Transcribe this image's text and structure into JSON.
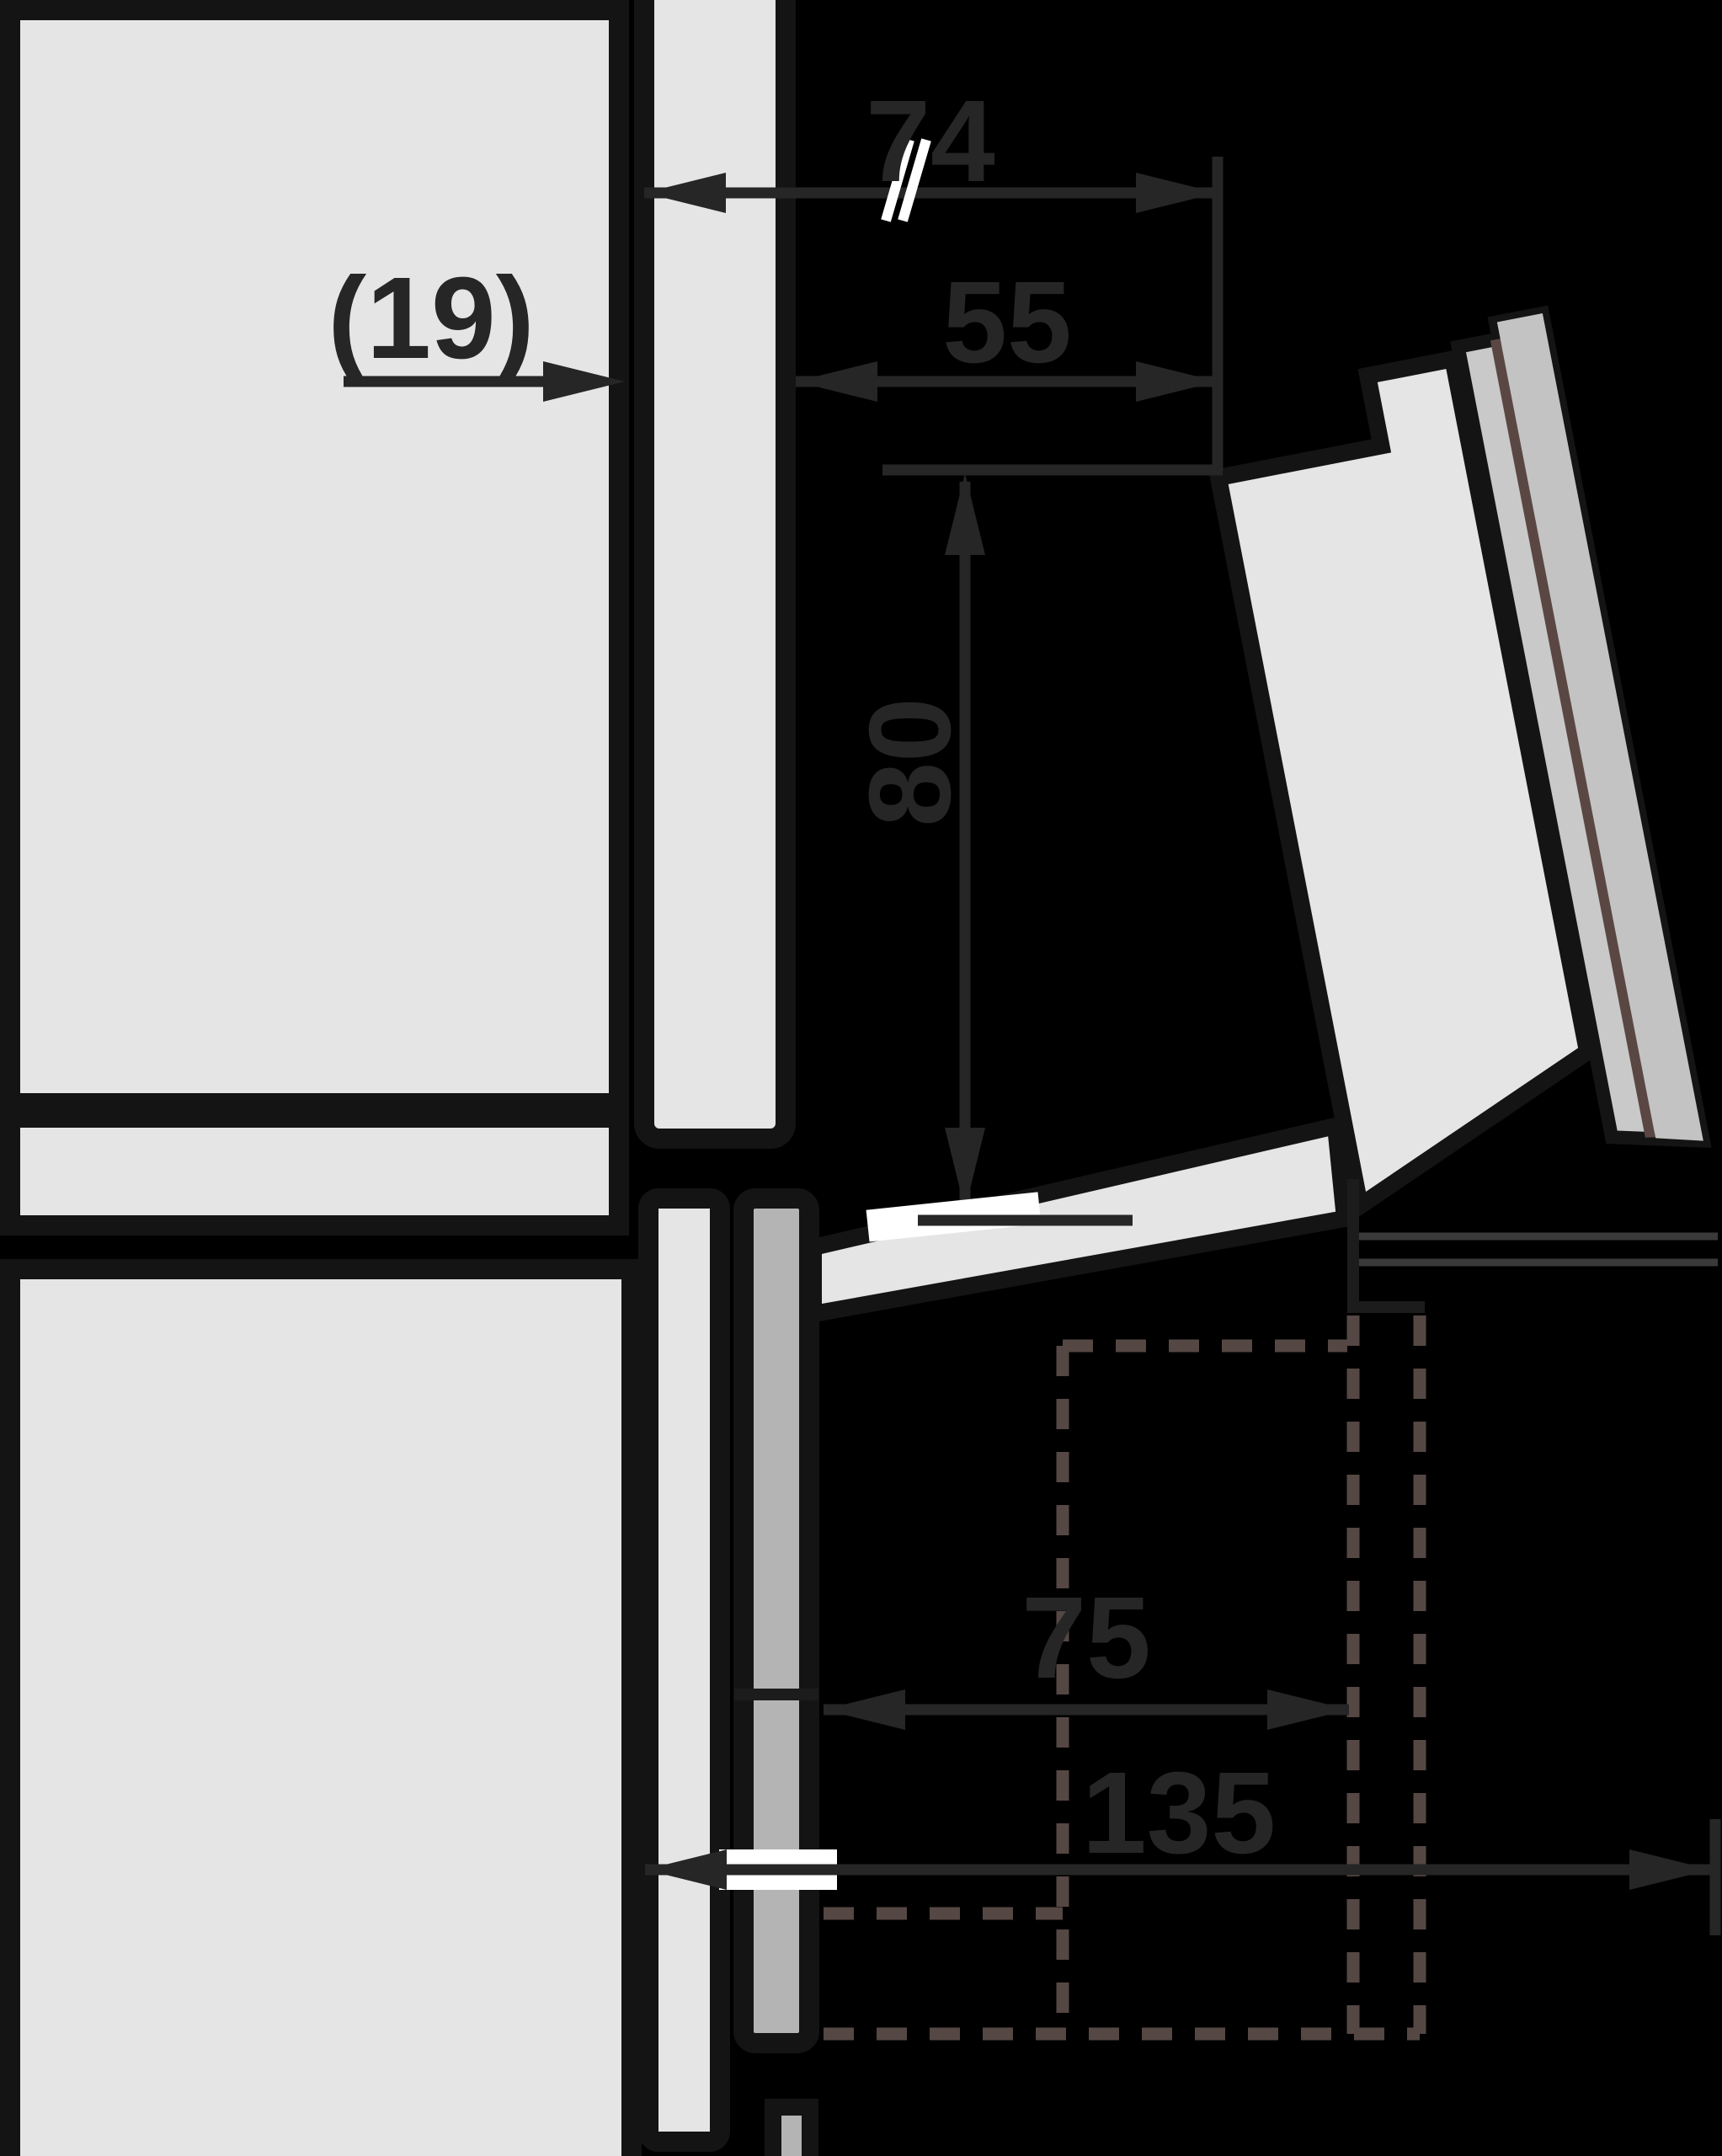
{
  "diagram": {
    "type": "appliance-installation-side-view",
    "units": "mm",
    "labels": {
      "d74": "74",
      "d19": "(19)",
      "d55": "55",
      "d80": "80",
      "d75": "75",
      "d135": "135"
    },
    "colors": {
      "background": "#000000",
      "cabinet_panel": "#e5e5e5",
      "niche_strip_gray": "#b4b4b4",
      "door_layer_gray_1": "#c9c9c9",
      "door_layer_gray_2": "#c3c3c3",
      "door_seal_brown": "#5a4743",
      "outline_black": "#141414",
      "dimension_stroke": "#262626",
      "hidden_dash": "#554743",
      "thin_reference_line": "#3a3a3a"
    }
  }
}
